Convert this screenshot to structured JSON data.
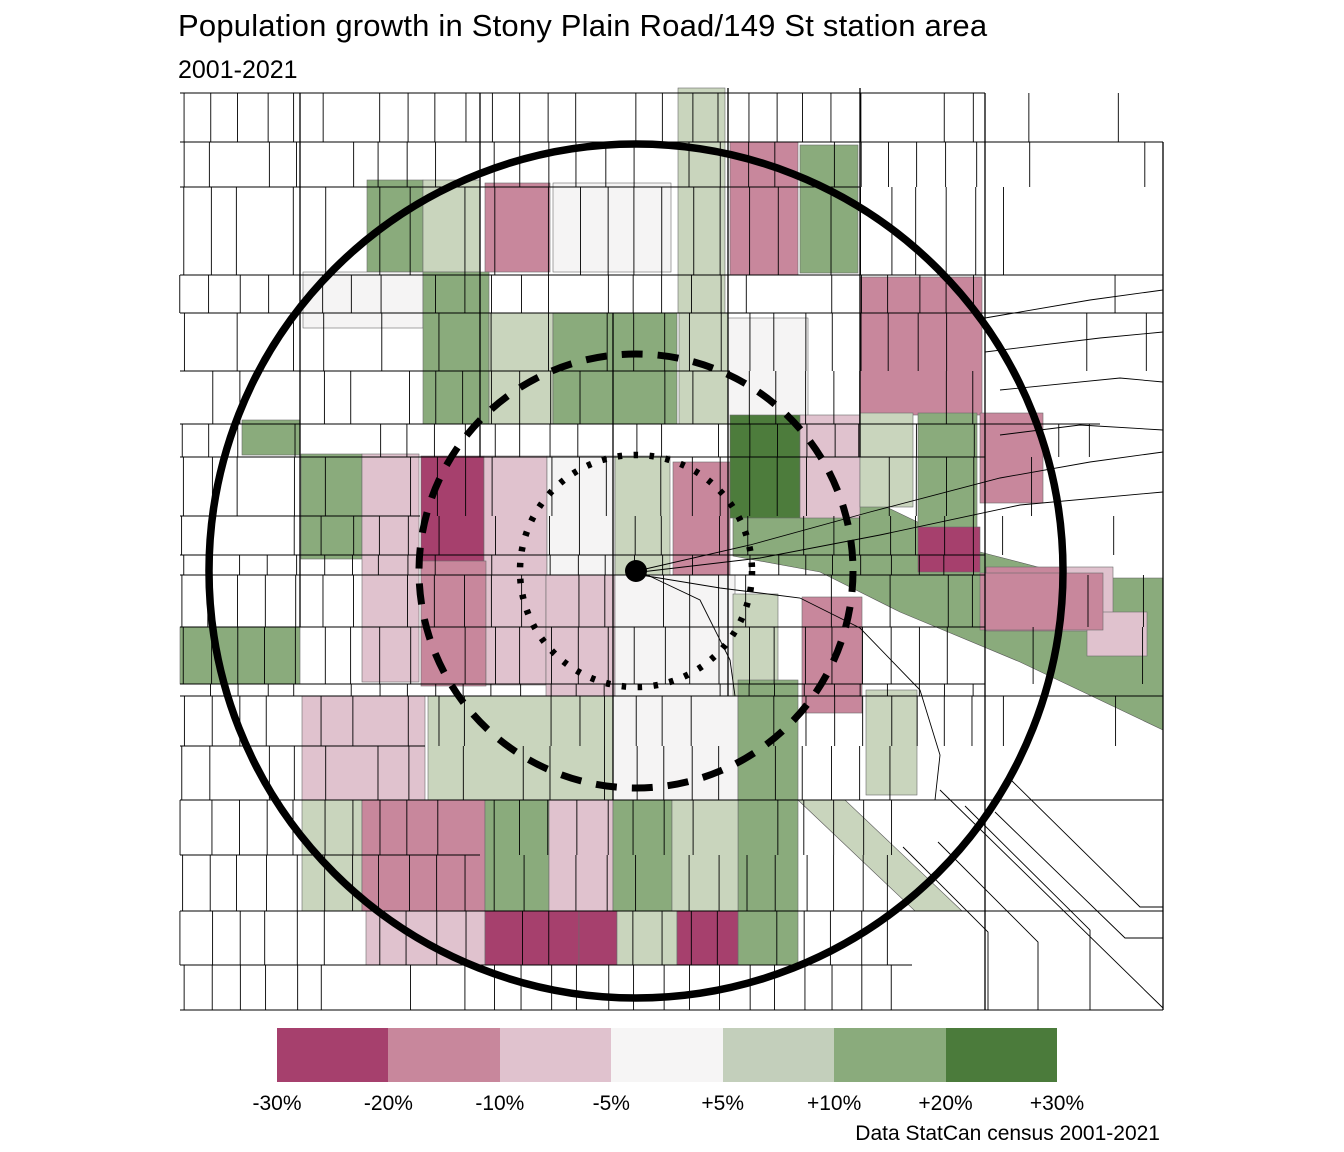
{
  "header": {
    "title": "Population growth in Stony Plain Road/149 St station area",
    "subtitle": "2001-2021"
  },
  "caption": "Data StatCan census 2001-2021",
  "legend": {
    "tick_labels": [
      "-30%",
      "-20%",
      "-10%",
      "-5%",
      "+5%",
      "+10%",
      "+20%",
      "+30%"
    ],
    "bins": [
      {
        "name": "-30% to -20%",
        "color": "#a6406d"
      },
      {
        "name": "-20% to -10%",
        "color": "#c8879c"
      },
      {
        "name": "-10% to -5%",
        "color": "#e0c2ce"
      },
      {
        "name": "-5% to +5%",
        "color": "#f6f5f5"
      },
      {
        "name": "+5% to +10%",
        "color": "#c3cfbb"
      },
      {
        "name": "+10% to +20%",
        "color": "#8aab7c"
      },
      {
        "name": "+20% to +30%",
        "color": "#4b7b3b"
      }
    ]
  },
  "map": {
    "viewbox": [
      170,
      85,
      1000,
      930
    ],
    "background": "#ffffff",
    "station": {
      "x": 636,
      "y": 571,
      "dot_radius": 11
    },
    "rings": [
      {
        "style": "solid",
        "radius": 427,
        "stroke_width": 7.5
      },
      {
        "style": "dashed",
        "radius": 217,
        "stroke_width": 7
      },
      {
        "style": "dotted",
        "radius": 116,
        "stroke_width": 6.5
      }
    ],
    "river_band": {
      "bin": "p10",
      "points": [
        [
          733,
          498
        ],
        [
          820,
          478
        ],
        [
          880,
          504
        ],
        [
          980,
          552
        ],
        [
          1080,
          578
        ],
        [
          1163,
          578
        ],
        [
          1163,
          730
        ],
        [
          1020,
          662
        ],
        [
          900,
          612
        ],
        [
          820,
          572
        ],
        [
          733,
          556
        ]
      ]
    },
    "diag_strip": {
      "bin": "p5",
      "points": [
        [
          798,
          800
        ],
        [
          845,
          800
        ],
        [
          962,
          911
        ],
        [
          915,
          911
        ]
      ]
    },
    "bin_colors": {
      "m30": "#a6406d",
      "m20": "#c8879c",
      "m10": "#e0c2ce",
      "z": "#f5f4f4",
      "p5": "#c9d5bd",
      "p10": "#8aab7c",
      "p20": "#4d7c3c"
    },
    "blocks": [
      [
        678,
        88,
        47,
        225,
        "p5"
      ],
      [
        367,
        180,
        56,
        92,
        "p10"
      ],
      [
        423,
        180,
        57,
        92,
        "p5"
      ],
      [
        485,
        183,
        65,
        89,
        "m20"
      ],
      [
        553,
        183,
        118,
        89,
        "z"
      ],
      [
        730,
        142,
        68,
        133,
        "m20"
      ],
      [
        800,
        145,
        58,
        128,
        "p10"
      ],
      [
        303,
        272,
        120,
        56,
        "z"
      ],
      [
        423,
        272,
        66,
        152,
        "p10"
      ],
      [
        489,
        313,
        64,
        111,
        "p5"
      ],
      [
        553,
        313,
        124,
        111,
        "p10"
      ],
      [
        679,
        313,
        49,
        111,
        "p5"
      ],
      [
        728,
        318,
        80,
        106,
        "z"
      ],
      [
        860,
        277,
        122,
        138,
        "m20"
      ],
      [
        242,
        420,
        58,
        35,
        "p10"
      ],
      [
        301,
        454,
        61,
        105,
        "p10"
      ],
      [
        362,
        454,
        57,
        228,
        "m10"
      ],
      [
        421,
        456,
        63,
        119,
        "m30"
      ],
      [
        484,
        456,
        63,
        119,
        "m10"
      ],
      [
        547,
        456,
        68,
        119,
        "z"
      ],
      [
        615,
        456,
        55,
        120,
        "p5"
      ],
      [
        673,
        462,
        57,
        113,
        "m20"
      ],
      [
        730,
        415,
        70,
        103,
        "p20"
      ],
      [
        800,
        415,
        60,
        103,
        "m10"
      ],
      [
        860,
        413,
        53,
        94,
        "p5"
      ],
      [
        918,
        413,
        59,
        117,
        "p10"
      ],
      [
        980,
        413,
        63,
        90,
        "m20"
      ],
      [
        421,
        561,
        65,
        125,
        "m20"
      ],
      [
        486,
        575,
        60,
        110,
        "m10"
      ],
      [
        546,
        575,
        69,
        142,
        "m10"
      ],
      [
        615,
        575,
        120,
        142,
        "z"
      ],
      [
        180,
        627,
        120,
        57,
        "p10"
      ],
      [
        733,
        594,
        45,
        185,
        "p5"
      ],
      [
        802,
        597,
        60,
        116,
        "m20"
      ],
      [
        302,
        696,
        123,
        104,
        "m10"
      ],
      [
        428,
        696,
        185,
        104,
        "p5"
      ],
      [
        613,
        696,
        125,
        104,
        "z"
      ],
      [
        738,
        680,
        60,
        285,
        "p10"
      ],
      [
        866,
        690,
        51,
        105,
        "p5"
      ],
      [
        302,
        800,
        60,
        111,
        "p5"
      ],
      [
        362,
        800,
        123,
        111,
        "m20"
      ],
      [
        485,
        800,
        64,
        111,
        "p10"
      ],
      [
        549,
        800,
        64,
        111,
        "m10"
      ],
      [
        613,
        800,
        59,
        111,
        "p10"
      ],
      [
        672,
        800,
        66,
        111,
        "p5"
      ],
      [
        366,
        911,
        119,
        54,
        "m10"
      ],
      [
        485,
        911,
        94,
        54,
        "m30"
      ],
      [
        579,
        911,
        38,
        54,
        "m30"
      ],
      [
        617,
        911,
        60,
        54,
        "p5"
      ],
      [
        677,
        911,
        61,
        54,
        "m30"
      ],
      [
        918,
        527,
        62,
        45,
        "m30"
      ],
      [
        986,
        567,
        76,
        64,
        "m20"
      ],
      [
        1062,
        567,
        51,
        64,
        "m10"
      ],
      [
        1087,
        612,
        60,
        44,
        "m10"
      ],
      [
        980,
        573,
        123,
        57,
        "m20"
      ]
    ],
    "streets": {
      "horizontals": [
        [
          93,
          180,
          985
        ],
        [
          142,
          180,
          1163
        ],
        [
          187,
          180,
          860
        ],
        [
          275,
          180,
          1163
        ],
        [
          313,
          180,
          1163
        ],
        [
          371,
          180,
          730
        ],
        [
          424,
          180,
          1100
        ],
        [
          457,
          180,
          985
        ],
        [
          516,
          180,
          420
        ],
        [
          555,
          180,
          985
        ],
        [
          575,
          180,
          985
        ],
        [
          627,
          180,
          985
        ],
        [
          684,
          180,
          985
        ],
        [
          696,
          180,
          1163
        ],
        [
          746,
          180,
          425
        ],
        [
          800,
          180,
          1163
        ],
        [
          855,
          180,
          480
        ],
        [
          911,
          180,
          1163
        ],
        [
          965,
          180,
          912
        ],
        [
          1010,
          180,
          1163
        ]
      ],
      "main_verticals": [
        [
          985,
          93,
          1010
        ],
        [
          728,
          88,
          696
        ],
        [
          860,
          88,
          457
        ],
        [
          613,
          313,
          800
        ],
        [
          300,
          93,
          627
        ],
        [
          480,
          93,
          457
        ],
        [
          1163,
          142,
          1010
        ]
      ],
      "polylines": [
        [
          [
            641,
            570
          ],
          [
            750,
            545
          ],
          [
            870,
            512
          ],
          [
            1000,
            478
          ],
          [
            1090,
            462
          ],
          [
            1163,
            452
          ]
        ],
        [
          [
            641,
            572
          ],
          [
            760,
            558
          ],
          [
            880,
            535
          ],
          [
            1020,
            505
          ],
          [
            1163,
            492
          ]
        ],
        [
          [
            641,
            575
          ],
          [
            720,
            588
          ],
          [
            800,
            598
          ],
          [
            860,
            628
          ],
          [
            920,
            690
          ],
          [
            940,
            755
          ],
          [
            935,
            800
          ]
        ],
        [
          [
            641,
            572
          ],
          [
            700,
            600
          ],
          [
            730,
            660
          ],
          [
            735,
            696
          ]
        ],
        [
          [
            940,
            790
          ],
          [
            1163,
            1008
          ]
        ],
        [
          [
            965,
            806
          ],
          [
            1090,
            930
          ],
          [
            1090,
            1010
          ]
        ],
        [
          [
            995,
            812
          ],
          [
            1125,
            938
          ],
          [
            1163,
            938
          ]
        ],
        [
          [
            938,
            842
          ],
          [
            1038,
            942
          ],
          [
            1038,
            1010
          ]
        ],
        [
          [
            903,
            847
          ],
          [
            988,
            932
          ],
          [
            988,
            1010
          ]
        ],
        [
          [
            1008,
            777
          ],
          [
            1140,
            907
          ],
          [
            1163,
            907
          ]
        ],
        [
          [
            985,
            318
          ],
          [
            1090,
            300
          ],
          [
            1163,
            290
          ]
        ],
        [
          [
            985,
            352
          ],
          [
            1100,
            338
          ],
          [
            1163,
            332
          ]
        ],
        [
          [
            1000,
            390
          ],
          [
            1120,
            378
          ],
          [
            1163,
            382
          ]
        ],
        [
          [
            1163,
            430
          ],
          [
            1080,
            425
          ],
          [
            1000,
            435
          ]
        ]
      ],
      "lot_line_spacing": 28.3,
      "left_edge": 180,
      "right_edge": 1163
    }
  }
}
